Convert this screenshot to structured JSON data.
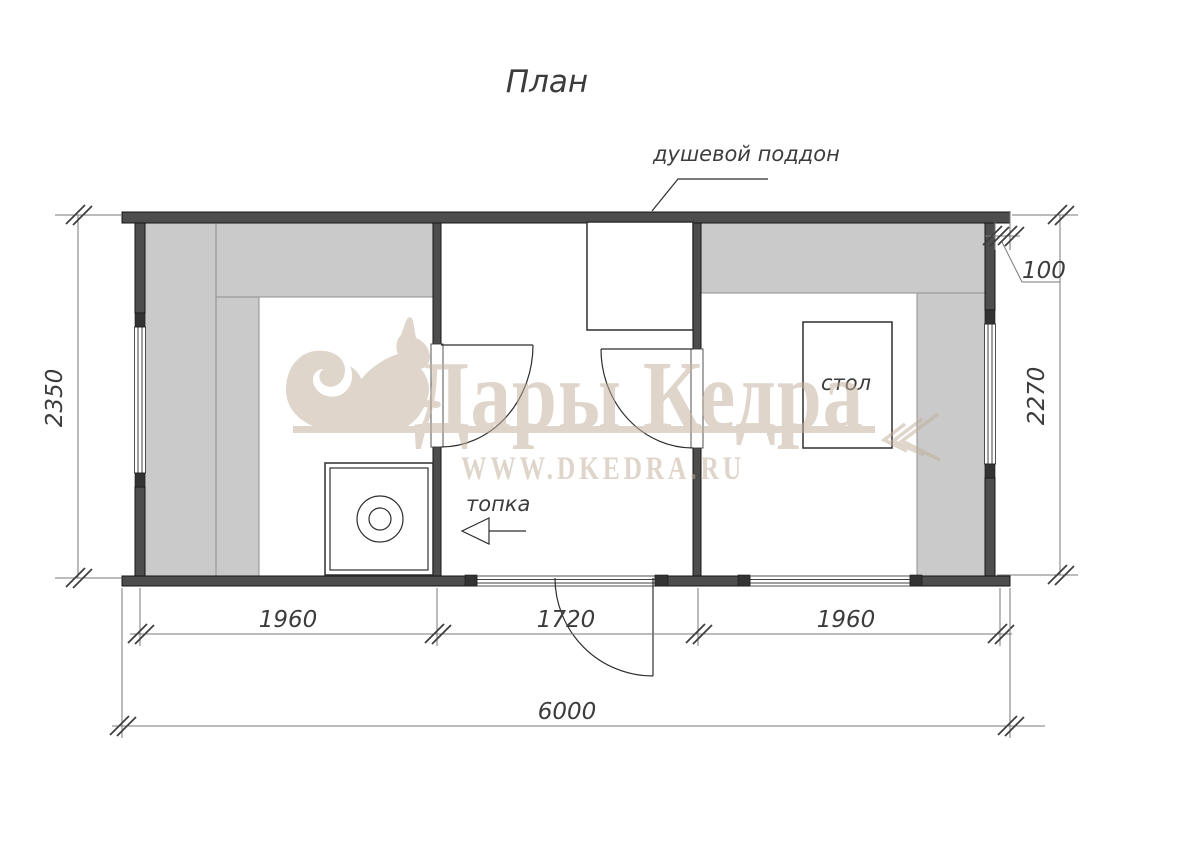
{
  "title": "План",
  "labels": {
    "shower": "душевой поддон",
    "furnace": "топка",
    "table": "стол"
  },
  "watermark": {
    "brand": "Дары Кедра",
    "site": "WWW.DKEDRA.RU"
  },
  "dims": {
    "left_room_width": "1960",
    "middle_room_width": "1720",
    "right_room_width": "1960",
    "total_width": "6000",
    "left_overall_height": "2350",
    "right_inner_height": "2270",
    "wall_thickness": "100"
  },
  "colors": {
    "wall": "#4d4d4d",
    "bench": "#cacaca",
    "line": "#3c3c3c",
    "watermark": "#ddd5c8",
    "background": "#ffffff"
  }
}
